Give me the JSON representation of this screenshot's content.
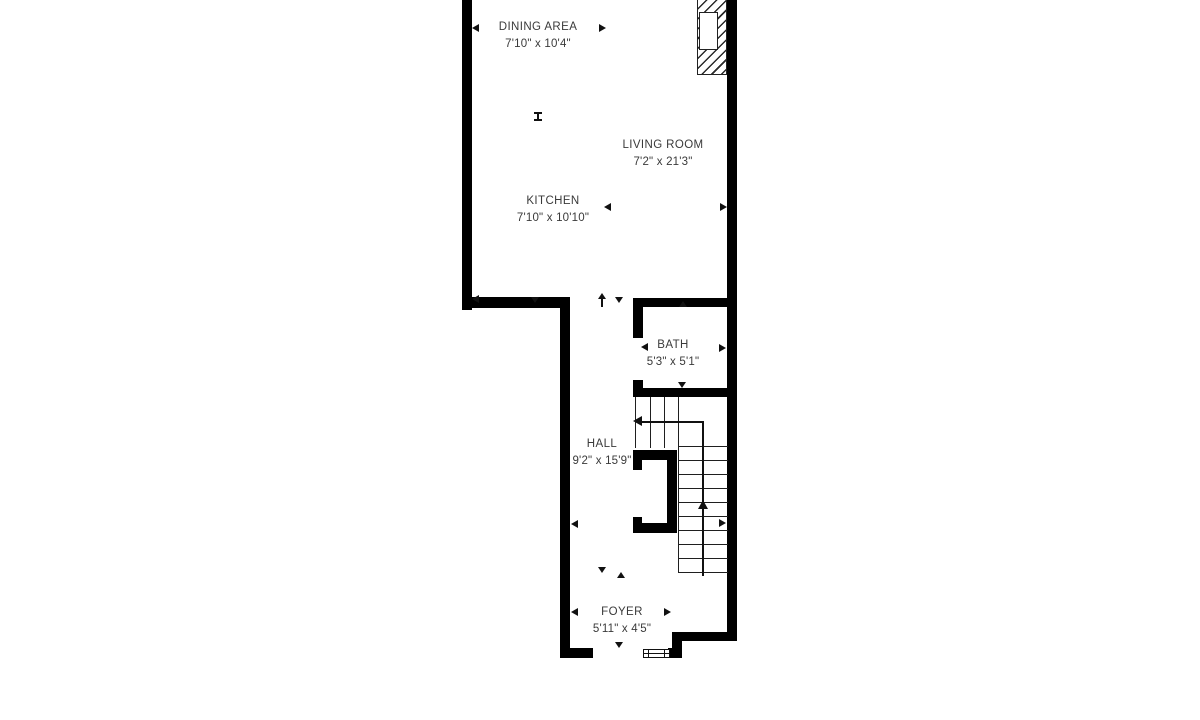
{
  "title": "Floor plan",
  "colors": {
    "wall": "#000000",
    "thin_line": "#1f1f1f",
    "text": "#3a3a3a",
    "background": "#ffffff"
  },
  "rooms": [
    {
      "name": "DINING AREA",
      "dims": "7'10\" x 10'4\""
    },
    {
      "name": "LIVING ROOM",
      "dims": "7'2\" x 21'3\""
    },
    {
      "name": "KITCHEN",
      "dims": "7'10\" x 10'10\""
    },
    {
      "name": "BATH",
      "dims": "5'3\" x 5'1\""
    },
    {
      "name": "HALL",
      "dims": "9'2\" x 15'9\""
    },
    {
      "name": "FOYER",
      "dims": "5'11\" x 4'5\""
    }
  ]
}
